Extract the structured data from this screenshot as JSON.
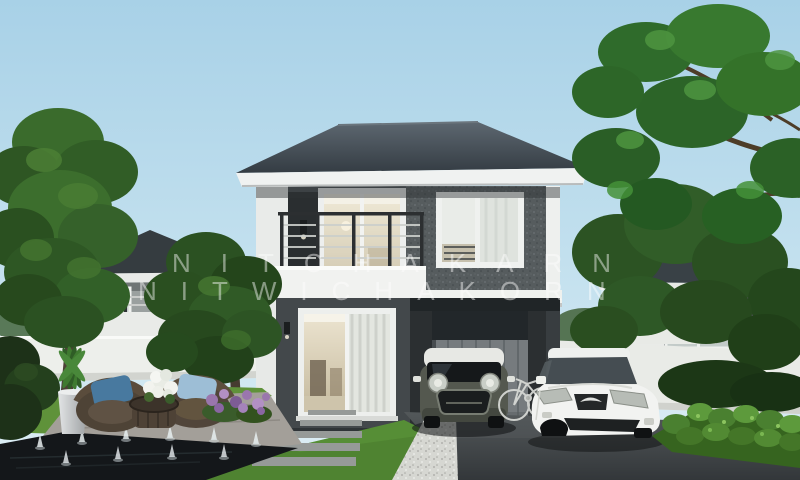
{
  "image": {
    "kind": "3d architectural rendering",
    "subject": "Modern two-storey detached house with balcony, carport, garden, reflecting pool and two parked cars",
    "setting": "Suburban housing estate in daylight"
  },
  "watermark": {
    "line1": "NITCHAKARN",
    "line2": "NITWICHAKORN",
    "color": "#ffffff",
    "opacity": 0.45
  },
  "palette": {
    "sky_top": "#a8d1e7",
    "sky_horizon": "#e0eff5",
    "roof": "#3f4850",
    "dark_wall": "#45494b",
    "speckled_wall": "#565c5e",
    "white_trim": "#eff1ef",
    "lawn_green": "#4f8331",
    "hedge_green": "#4a8030",
    "pool_dark": "#14171a",
    "asphalt": "#3f4345",
    "gravel": "#d6d7d2",
    "mini_body": "#54584f",
    "mini_roof": "#e7e8e4",
    "sedan_white": "#f1f2f0",
    "cushion_blue_dark": "#48799f",
    "cushion_blue_light": "#9dbed6",
    "flower_purple": "#9a76ad"
  },
  "objects": [
    {
      "name": "main-house",
      "label": "Two-storey house, charcoal walls, white trim, hip roof"
    },
    {
      "name": "balcony",
      "label": "Second-floor balcony with metal railing"
    },
    {
      "name": "carport",
      "label": "Carport under upper floor with grey garage door"
    },
    {
      "name": "mini-car",
      "label": "Dark hatchback with white roof in carport"
    },
    {
      "name": "white-sedan",
      "label": "White sedan on driveway"
    },
    {
      "name": "bicycle",
      "label": "Bicycle beside carport pillar"
    },
    {
      "name": "reflecting-pool",
      "label": "Dark reflecting pool with fountain jets"
    },
    {
      "name": "garden-furniture",
      "label": "Two rattan chairs with blue cushions and wicker table"
    },
    {
      "name": "neighbor-houses",
      "label": "Matching two-storey houses in background"
    },
    {
      "name": "trees",
      "label": "Green garden trees framing the scene"
    }
  ]
}
